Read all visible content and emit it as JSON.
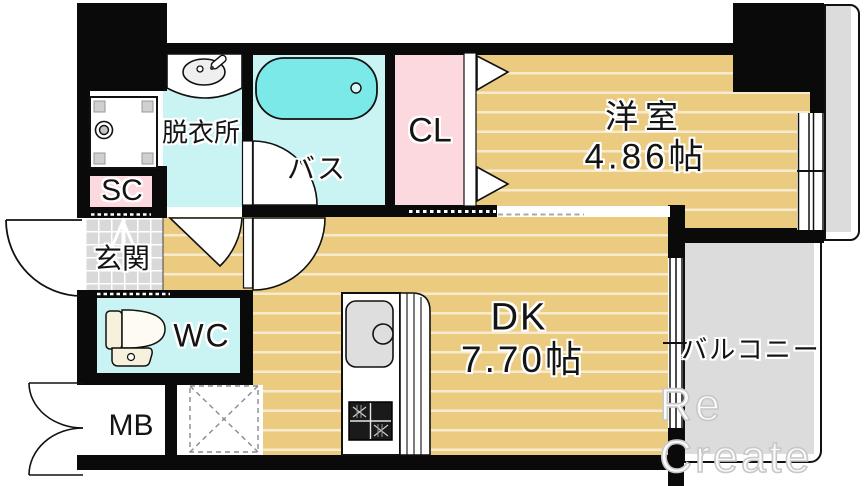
{
  "title": "1K apartment floor plan",
  "rooms": {
    "western_room": {
      "name": "洋室",
      "size": "4.86帖"
    },
    "dining_kitchen": {
      "name": "DK",
      "size": "7.70帖"
    },
    "balcony": {
      "name": "バルコニー"
    },
    "bath": {
      "name": "バス"
    },
    "dressing_room": {
      "name": "脱衣所"
    },
    "closet": {
      "name": "CL"
    },
    "shoe_closet": {
      "name": "SC"
    },
    "entrance": {
      "name": "玄関"
    },
    "toilet": {
      "name": "WC"
    },
    "meter_box": {
      "name": "MB"
    }
  },
  "watermark": "Re Create",
  "fixtures": [
    "bathtub-icon",
    "washroom-sink-icon",
    "washing-machine-pan-icon",
    "toilet-icon",
    "kitchen-sink-icon",
    "gas-stove-icon",
    "refrigerator-space-icon",
    "bifold-closet-door-icon",
    "door-swing-arc-icon",
    "entrance-step-arrow-icon",
    "sliding-window-icon"
  ],
  "colors": {
    "floor_tan": "#EBCB80",
    "wet_area_cyan": "#C9F4F3",
    "bathtub_cyan": "#7BE9E8",
    "closet_pink": "#FBD9DE",
    "balcony_gray": "#DCDCDC",
    "entrance_tile_gray": "#D9D9D9",
    "wall_black": "#0A0A0A"
  }
}
